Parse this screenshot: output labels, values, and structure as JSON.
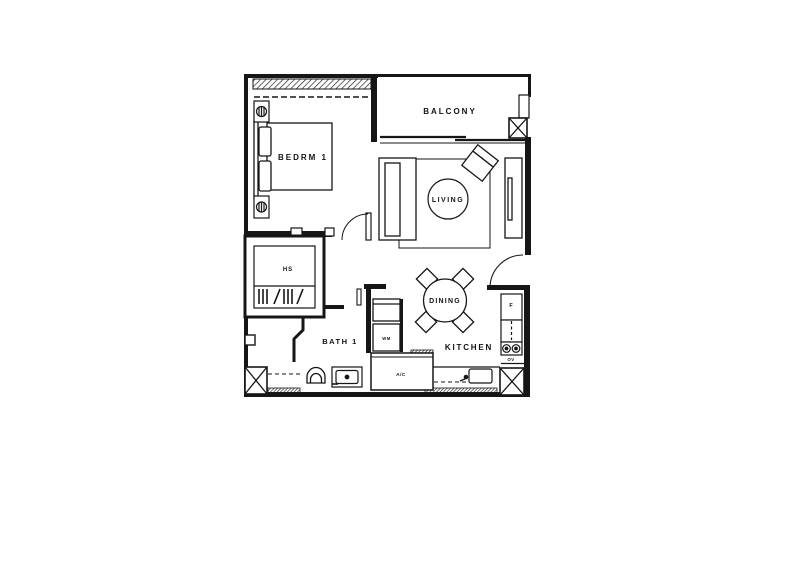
{
  "floorplan": {
    "type": "apartment-floor-plan",
    "line_color": "#161616",
    "background": "#ffffff",
    "labels": {
      "bedroom": "BEDRM 1",
      "balcony": "BALCONY",
      "living": "LIVING",
      "dining": "DINING",
      "kitchen": "KITCHEN",
      "bath": "BATH 1",
      "household_shelter": "HS",
      "washing_machine": "WM",
      "aircon_ledge": "A/C",
      "fridge": "F",
      "oven": "OV"
    }
  }
}
